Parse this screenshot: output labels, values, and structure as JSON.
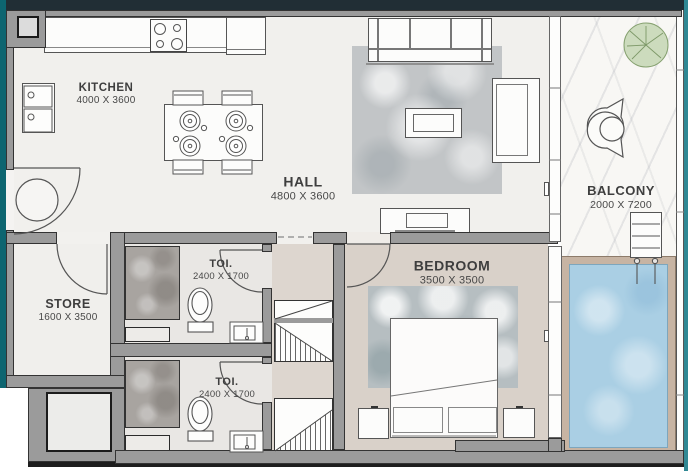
{
  "rooms": {
    "kitchen": {
      "name": "KITCHEN",
      "dims": "4000 X 3600"
    },
    "hall": {
      "name": "HALL",
      "dims": "4800 X 3600"
    },
    "balcony": {
      "name": "BALCONY",
      "dims": "2000 X 7200"
    },
    "bedroom": {
      "name": "BEDROOM",
      "dims": "3500 X 3500"
    },
    "toilet1": {
      "name": "TOI.",
      "dims": "2400 X 1700"
    },
    "toilet2": {
      "name": "TOI.",
      "dims": "2400 X 1700"
    },
    "store": {
      "name": "STORE",
      "dims": "1600 X 3500"
    }
  },
  "colors": {
    "wall_fill": "#9b9b9b",
    "wall_outline": "#333333",
    "top_band": "#212e35",
    "edge_teal_left": "#0d6570",
    "edge_teal_right": "#2f8894",
    "floor_main": "#f1f0ed",
    "floor_bedroom": "#d9d1c9",
    "floor_corridor": "#ddd6cf",
    "floor_toilet": "#e9e7e4",
    "shower_tile": "#a8a4a0",
    "pool_water": "#aacfe4",
    "pool_deck": "#c7b4a3",
    "plant_green": "#ccdbbd",
    "rug_hall": "#c2c5c7",
    "rug_bedroom": "#b6bec1",
    "label_text": "#3e3e3e"
  },
  "features": [
    "kitchen-counter",
    "stove",
    "fridge",
    "kitchen-sink",
    "dining-table",
    "dining-chairs",
    "sofa",
    "coffee-table",
    "armchair",
    "tv-unit",
    "hall-rug",
    "bed",
    "pillows",
    "nightstands",
    "bedroom-rug",
    "toilet-wc",
    "washbasin",
    "shower",
    "bench",
    "entrance-door",
    "store-door",
    "bedroom-door",
    "toilet-doors",
    "plant",
    "lounge-chairs",
    "side-table",
    "pool",
    "pool-ladder",
    "duct-shafts",
    "service-shaft"
  ]
}
